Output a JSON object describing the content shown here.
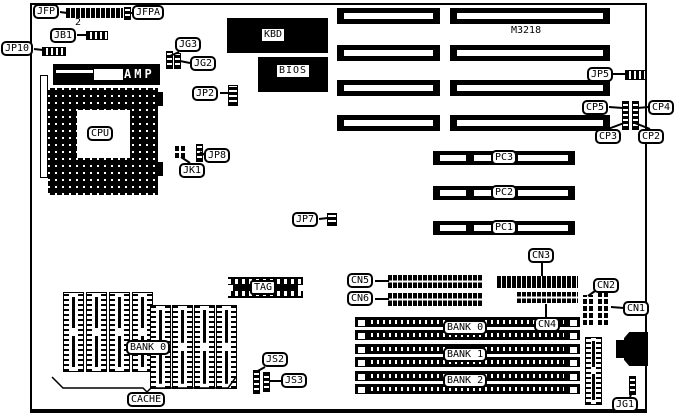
{
  "board": {
    "model": "M3218"
  },
  "labels": {
    "jfp": "JFP",
    "jfpa": "JFPA",
    "jb1": "JB1",
    "jp10": "JP10",
    "jg3": "JG3",
    "jg2": "JG2",
    "jp2": "JP2",
    "jp5": "JP5",
    "jp7": "JP7",
    "jp8": "JP8",
    "jk1": "JK1",
    "cp2": "CP2",
    "cp3": "CP3",
    "cp4": "CP4",
    "cp5": "CP5",
    "cn1": "CN1",
    "cn2": "CN2",
    "cn3": "CN3",
    "cn4": "CN4",
    "cn5": "CN5",
    "cn6": "CN6",
    "js2": "JS2",
    "js3": "JS3",
    "jg1": "JG1"
  },
  "chips": {
    "kbd": "KBD",
    "bios": "BIOS",
    "tag": "TAG",
    "cpu": "CPU",
    "amp": "AMP"
  },
  "memory": {
    "cache_bank": "BANK 0",
    "cache": "CACHE",
    "banks": [
      "BANK 0",
      "BANK 1",
      "BANK 2"
    ]
  },
  "slots": {
    "pci": [
      "PC1",
      "PC2",
      "PC3"
    ]
  },
  "misc": {
    "pin2": "2"
  }
}
